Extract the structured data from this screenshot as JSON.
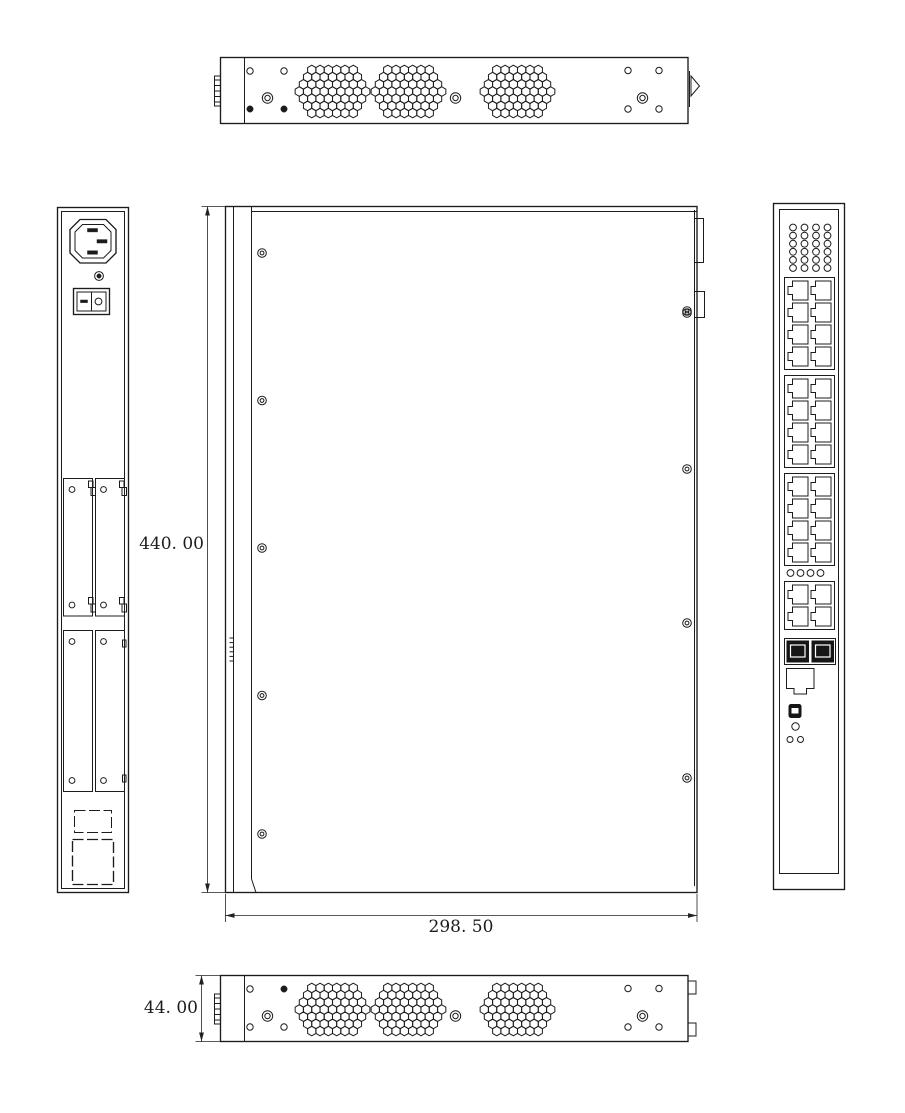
{
  "page": {
    "background": "#ffffff",
    "line_color": "#1c1c1c"
  },
  "dimensions": {
    "height": {
      "label": "440. 00",
      "value": 440.0
    },
    "width": {
      "label": "298. 50",
      "value": 298.5
    },
    "depth": {
      "label": "44. 00",
      "value": 44.0
    }
  },
  "views": {
    "top_view": {
      "vent_clusters": 3,
      "screws": 3,
      "holes": 8
    },
    "bottom_view": {
      "vent_clusters": 3,
      "screws": 3,
      "holes": 8
    },
    "rear_view": {
      "power_inlet": 1,
      "power_switch": 1,
      "slot_covers": 4,
      "cover_screw_holes": 8,
      "knockouts": 2
    },
    "main_view": {
      "left_screws": 5,
      "right_screws": 4
    },
    "front_view": {
      "vent_grid": {
        "cols": 4,
        "rows": 6
      },
      "rj45_blocks": [
        8,
        8,
        8,
        4
      ],
      "led_holes": 4,
      "sfp_cages": 2,
      "console_ports": 1,
      "mini_usb": 1,
      "indicator_holes": 3
    }
  }
}
